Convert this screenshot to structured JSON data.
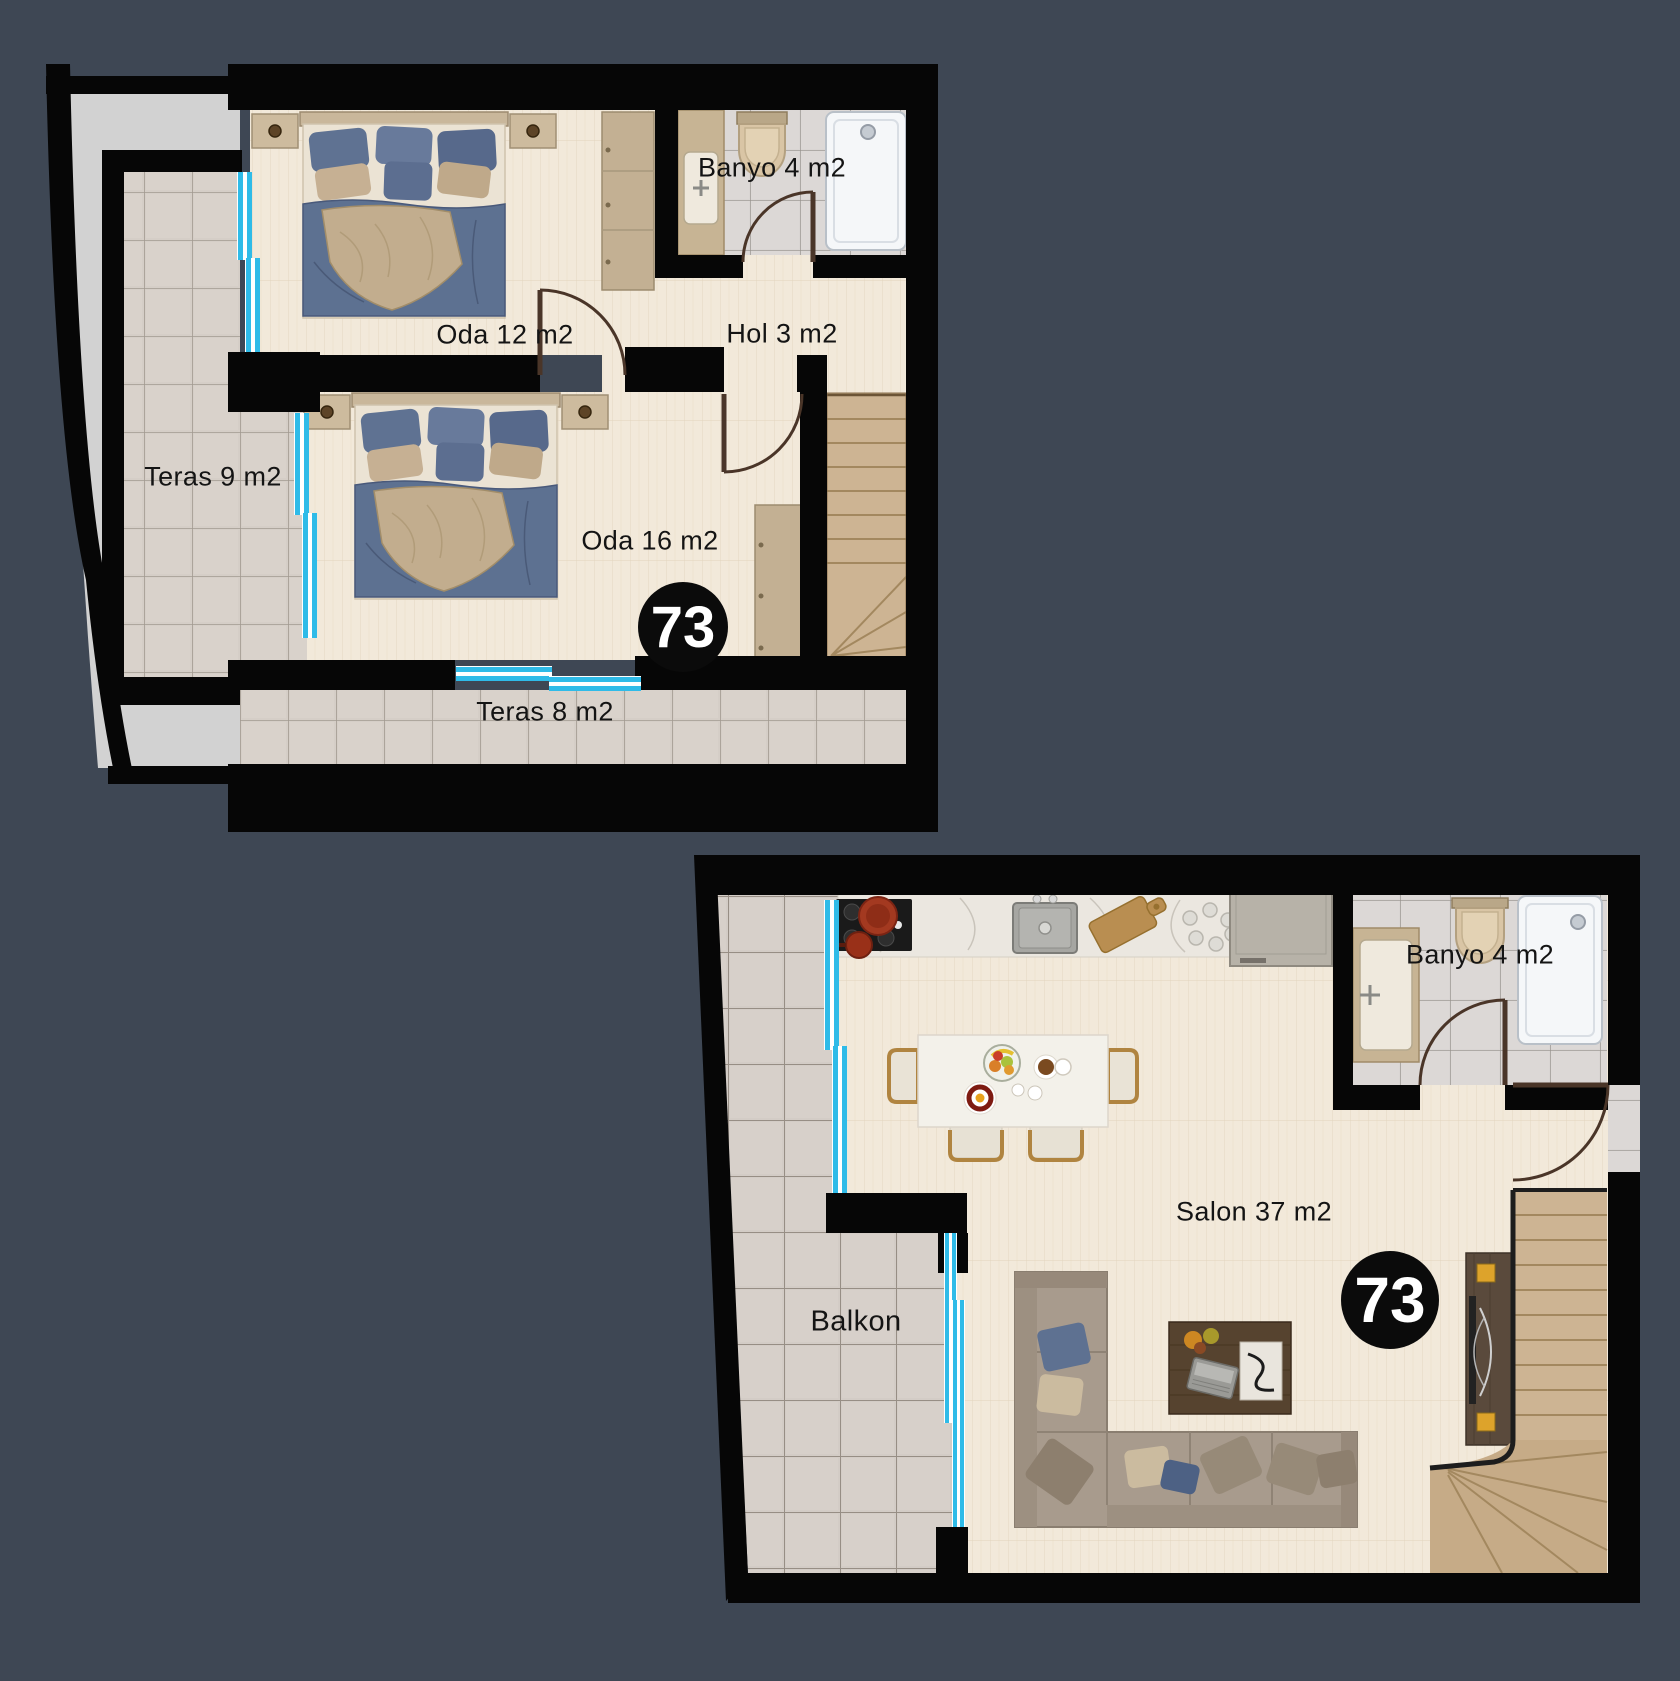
{
  "page": {
    "background_color": "#3e4754"
  },
  "floorplan": {
    "unit_number": "73",
    "upper_floor": {
      "rooms": [
        {
          "label": "Oda 12 m2"
        },
        {
          "label": "Banyo 4 m2"
        },
        {
          "label": "Hol 3 m2"
        },
        {
          "label": "Teras 9 m2"
        },
        {
          "label": "Oda 16 m2"
        },
        {
          "label": "Teras 8 m2"
        }
      ]
    },
    "lower_floor": {
      "rooms": [
        {
          "label": "Banyo 4 m2"
        },
        {
          "label": "Salon 37 m2"
        },
        {
          "label": "Balkon"
        }
      ]
    },
    "colors": {
      "wall": "#060606",
      "wood_floor": "#f2e9da",
      "terrace_tile": "#d5cec7",
      "window": "#2fbbe8",
      "roof_area": "#d2d2d2"
    }
  }
}
